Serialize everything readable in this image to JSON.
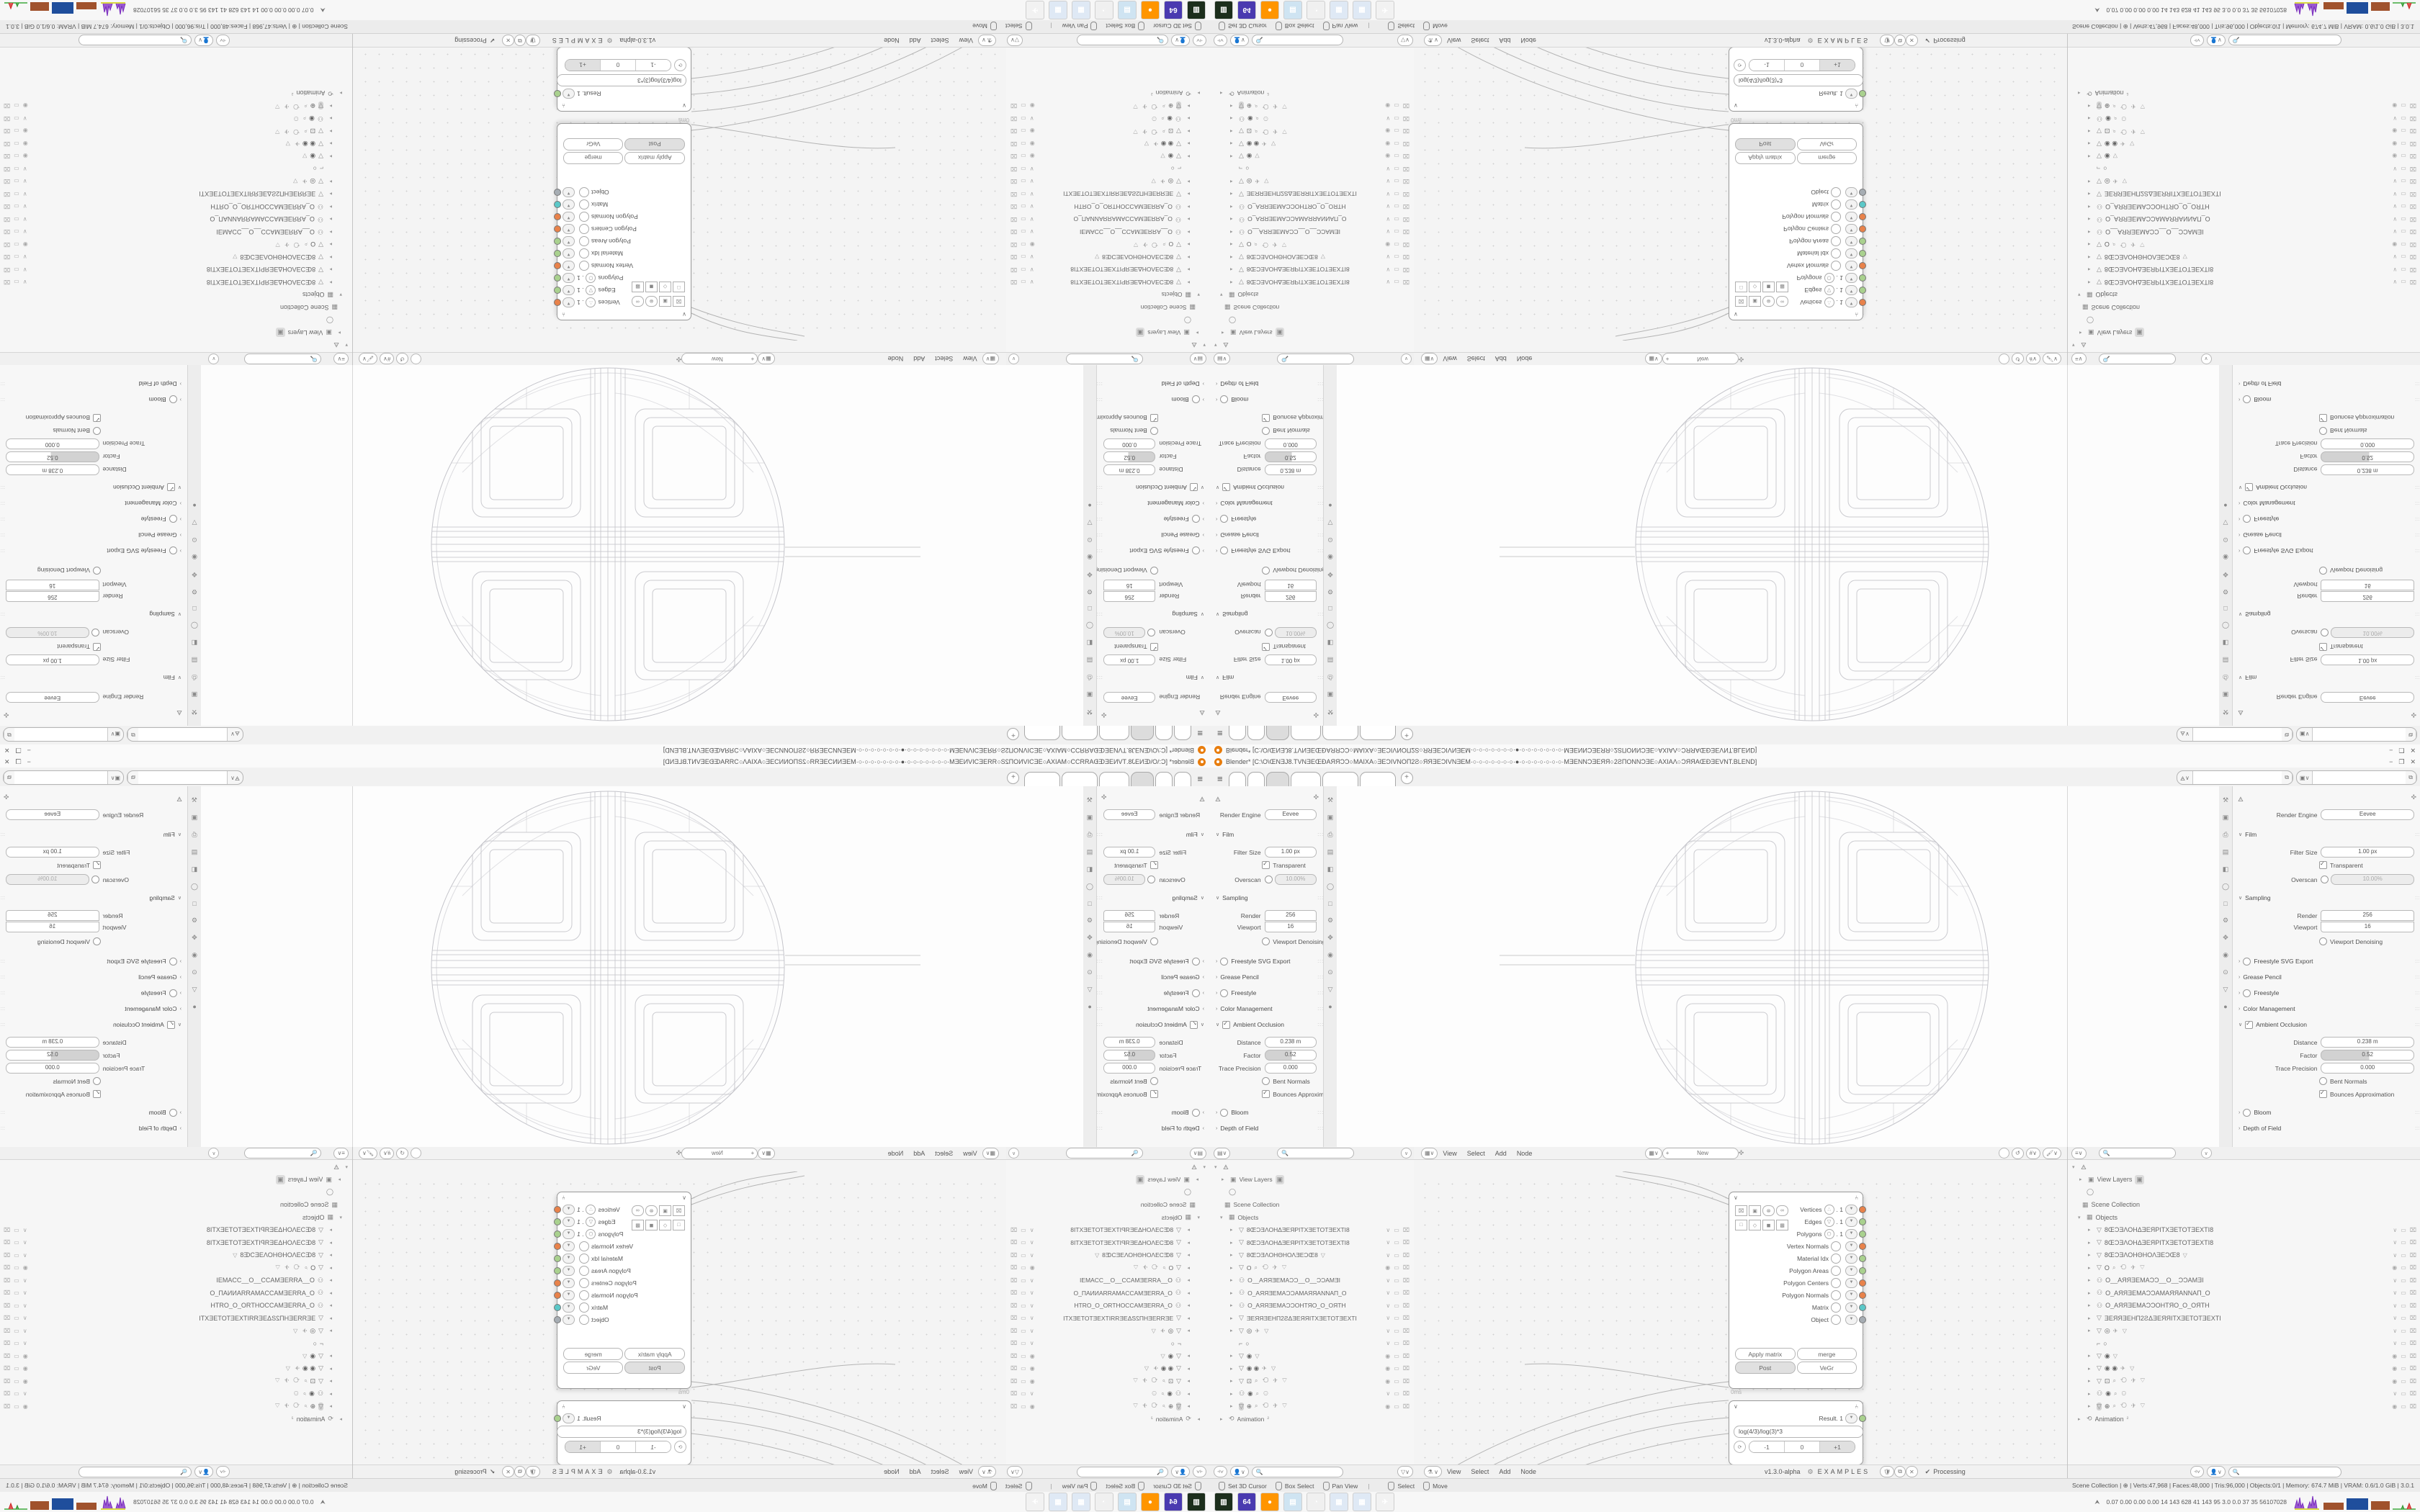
{
  "window": {
    "title": "Blender*  [C:\\O\\ŒNƎJ8.TVNƎEŒÐAЯЯƆϽ○MAIXA○ƎEϽIVNOΠ2Ƨ○ЯЯƎEϽIVNƎEM·○·○·○·○·○·○·○·●·○·○·○·○·○·○·○·MƎENNϽƎEЯЯ○2ƧΠONNϽƎE○AXIAΛ○ϽЯЯAŒÐƎEVNT.BLEND]",
    "minimize": "−",
    "maximize": "❐",
    "close": "✕",
    "new_tab": "+",
    "menu_icon": "≡"
  },
  "id_selectors": {
    "scene_icon": "🜁",
    "image_icon": "▣",
    "copy_icon": "⧉",
    "chevron": "∨",
    "value": ""
  },
  "properties": {
    "engine_label": "Render Engine",
    "engine_value": "Eevee",
    "film": "Film",
    "filter_label": "Filter Size",
    "filter_value": "1.00 px",
    "transparent": "Transparent",
    "overscan_label": "Overscan",
    "overscan_value": "10.00%",
    "sampling": "Sampling",
    "render_label": "Render",
    "render_value": "256",
    "viewport_label": "Viewport",
    "viewport_value": "16",
    "denoising": "Viewport Denoising",
    "freestyle_svg": "Freestyle SVG Export",
    "grease": "Grease Pencil",
    "freestyle": "Freestyle",
    "color_mgmt": "Color Management",
    "ao": "Ambient Occlusion",
    "distance_label": "Distance",
    "distance_value": "0.238 m",
    "factor_label": "Factor",
    "factor_value": "0.52",
    "trace_label": "Trace Precision",
    "trace_value": "0.000",
    "bent": "Bent Normals",
    "bounces": "Bounces Approximation",
    "bloom": "Bloom",
    "dof": "Depth of Field",
    "tab_icons": [
      "⚒",
      "📷",
      "⎙",
      "▣",
      "▤",
      "◯",
      "□",
      "🔧",
      "✥",
      "◉",
      "⊙",
      "▽",
      "●"
    ]
  },
  "viewport": {
    "mode": "Object Mode",
    "menus": [
      {
        "label": "View"
      },
      {
        "label": "Select"
      },
      {
        "label": "Add"
      },
      {
        "label": "Object"
      }
    ],
    "orientation": "Global",
    "orientation_icon": "⟲",
    "snap_icon": "🧲",
    "prop_icon": "⊙",
    "shading": [
      "⊞",
      "●",
      "◐",
      "◯"
    ]
  },
  "node_editor": {
    "menus": [
      {
        "label": "View"
      },
      {
        "label": "Select"
      },
      {
        "label": "Add"
      },
      {
        "label": "Node"
      }
    ],
    "new_label": "New",
    "plus": "+",
    "pin_icon": "📌",
    "version": "v1.3.0-alpha",
    "examples": "EXAMPLES",
    "processing": "Processing",
    "check": "✔",
    "dna_icon": "⚙",
    "tree_icon": "⚗"
  },
  "objects_node": {
    "outputs": [
      {
        "name": "Vertices",
        "suffix": ". 1",
        "icon": "∴",
        "color": "#e8824a"
      },
      {
        "name": "Edges",
        "suffix": ". 1",
        "icon": "▽",
        "color": "#a9d18e"
      },
      {
        "name": "Polygons",
        "suffix": ". 1",
        "icon": "⬡",
        "color": "#a9d18e"
      },
      {
        "name": "Vertex Normals",
        "suffix": "",
        "icon": "",
        "color": "#e8824a"
      },
      {
        "name": "Material Idx",
        "suffix": "",
        "icon": "",
        "color": "#a9d18e"
      },
      {
        "name": "Polygon Areas",
        "suffix": "",
        "icon": "",
        "color": "#a9d18e"
      },
      {
        "name": "Polygon Centers",
        "suffix": "",
        "icon": "",
        "color": "#e8824a"
      },
      {
        "name": "Polygon Normals",
        "suffix": "",
        "icon": "",
        "color": "#e8824a"
      },
      {
        "name": "Matrix",
        "suffix": "",
        "icon": "",
        "color": "#5bc8c8"
      },
      {
        "name": "Object",
        "suffix": "",
        "icon": "",
        "color": "#a6adb3"
      }
    ],
    "btn_apply": "Apply matrix",
    "btn_merge": "merge",
    "btn_post": "Post",
    "btn_vegr": "VeGr",
    "input_label": "Objects. 1",
    "input_color": "#8fbe8f",
    "time": "0ms"
  },
  "formula_node": {
    "output": "Result. 1",
    "output_color": "#a9d18e",
    "formula": "log(4/3)/log(3)*3",
    "btn_m1": "-1",
    "btn_0": "0",
    "btn_p1": "+1",
    "refresh_icon": "⟳"
  },
  "outliner": {
    "root_icon": "🜁",
    "view_layers": "View Layers",
    "scene_collection": "Scene Collection",
    "objects_label": "Objects",
    "animation": "Animation",
    "animation_badge": "²",
    "items": [
      {
        "lead": "▸",
        "icon": "▽",
        "name": "8ŒƆƎΛΟΗΔƎΕЯΡΙΤΧƎΕΤΟΤƎΕΧΤΙ8",
        "extras": "",
        "eye": "∨",
        "cls": ""
      },
      {
        "lead": "▸",
        "icon": "▽",
        "name": "8ŒƆƎΛΟΗΔƎΕЯΡΙΤΧƎΕΤΟΤƎΕΧΤΙ8",
        "extras": "",
        "eye": "∨",
        "cls": ""
      },
      {
        "lead": "▸",
        "icon": "▽",
        "name": "8ŒƆƎΛΟΗΘΗΟΛƎΕƆŒ8",
        "extras": "▽",
        "eye": "∨",
        "cls": ""
      },
      {
        "lead": "▸",
        "icon": "▽",
        "name": "O",
        "extras": "⌕ ⟲ ✈ ▽",
        "eye": "◉",
        "cls": ""
      },
      {
        "lead": "▸",
        "icon": "⚇",
        "name": "O__АЯЯƎΕΜΑƆƆ__O__ƆƆΑΜƎΙ",
        "extras": "",
        "eye": "∨",
        "cls": ""
      },
      {
        "lead": "▸",
        "icon": "⚇",
        "name": "O_АЯЯƎΕΜΑƆƆΑΜΑЯЯΑΝΝΑΠ_O",
        "extras": "",
        "eye": "∨",
        "cls": ""
      },
      {
        "lead": "▸",
        "icon": "⚇",
        "name": "O_АЯЯƎΕΜΑƆƆΟΗΤЯΟ_O_ΟЯΤΗ",
        "extras": "",
        "eye": "∨",
        "cls": ""
      },
      {
        "lead": "▸",
        "icon": "▽",
        "name": "ƎΕЯЯƎΕΗΠ2ƧΔƎΕЯЯΙΤΧƎΕΤΟΤƎΕΧΤΙ",
        "extras": "",
        "eye": "∨",
        "cls": ""
      },
      {
        "lead": "▸",
        "icon": "▽",
        "name": "◎",
        "extras": "✈ ▽",
        "eye": "∨",
        "cls": ""
      },
      {
        "lead": "",
        "icon": "⌐",
        "name": "○",
        "extras": "",
        "eye": "∨",
        "cls": ""
      },
      {
        "lead": "▸",
        "icon": "▽",
        "name": "◉",
        "extras": "▽",
        "eye": "◉",
        "cls": ""
      },
      {
        "lead": "▸",
        "icon": "▽",
        "name": "◉ ◉",
        "extras": "✈ ▽",
        "eye": "◉",
        "cls": ""
      },
      {
        "lead": "▸",
        "icon": "▽",
        "name": "⊡",
        "extras": "⌕ ⟲ ✈ ▽",
        "eye": "◉",
        "cls": ""
      },
      {
        "lead": "▸",
        "icon": "⚇",
        "name": "◉",
        "extras": "⌕ ⚇",
        "eye": "∨",
        "cls": ""
      },
      {
        "lead": "▸",
        "icon": "▽",
        "name": "⊕",
        "extras": "⌕ ⟲ ✈ ▽",
        "eye": "◉",
        "cls": "sel"
      }
    ],
    "toggle_screen": "▭",
    "toggle_camera": "⌧",
    "filter_icons": [
      "⫞",
      "👤"
    ],
    "filter_funnel": "▽"
  },
  "statusbar": {
    "hints": [
      {
        "label": "Set 3D Cursor"
      },
      {
        "label": "Box Select"
      },
      {
        "label": "Pan View"
      }
    ],
    "hints2": [
      {
        "label": "Select"
      },
      {
        "label": "Move"
      }
    ],
    "info": "Scene Collection | ⊕ | Verts:47,968 | Faces:48,000 | Tris:96,000 | Objects:0/1 | Memory: 674.7 MiB | VRAM: 0.6/1.0 GiB | 3.0.1"
  },
  "taskbar": {
    "apps": [
      {
        "label": "▥",
        "bg": "#1c2e1c",
        "fg": "#55d055",
        "title": "emulator"
      },
      {
        "label": "64",
        "bg": "#4a3ab0",
        "fg": "#ffffff",
        "title": "floppy-64"
      },
      {
        "label": "●",
        "bg": "#ff9500",
        "fg": "#7b2fbe",
        "title": "firefox"
      },
      {
        "label": "▤",
        "bg": "#cfe4f2",
        "fg": "#6b8aa0",
        "title": "notepad"
      },
      {
        "label": "◔",
        "bg": "#f0f0f0",
        "fg": "#e87d0d",
        "title": "blender"
      },
      {
        "label": "▦",
        "bg": "#dfe9f5",
        "fg": "#3a6bc0",
        "title": "calculator"
      },
      {
        "label": "▦",
        "bg": "#dfe9f5",
        "fg": "#3a6bc0",
        "title": "calculator"
      },
      {
        "label": "✈",
        "bg": "#f2f2f2",
        "fg": "#c9c9c9",
        "title": "inactive"
      }
    ],
    "updown_icon": "⮝",
    "stats": "0.07 0.00 0.00 0.00   14   143   628   41   143   95   3.0   0.0   37   35   56107028"
  }
}
